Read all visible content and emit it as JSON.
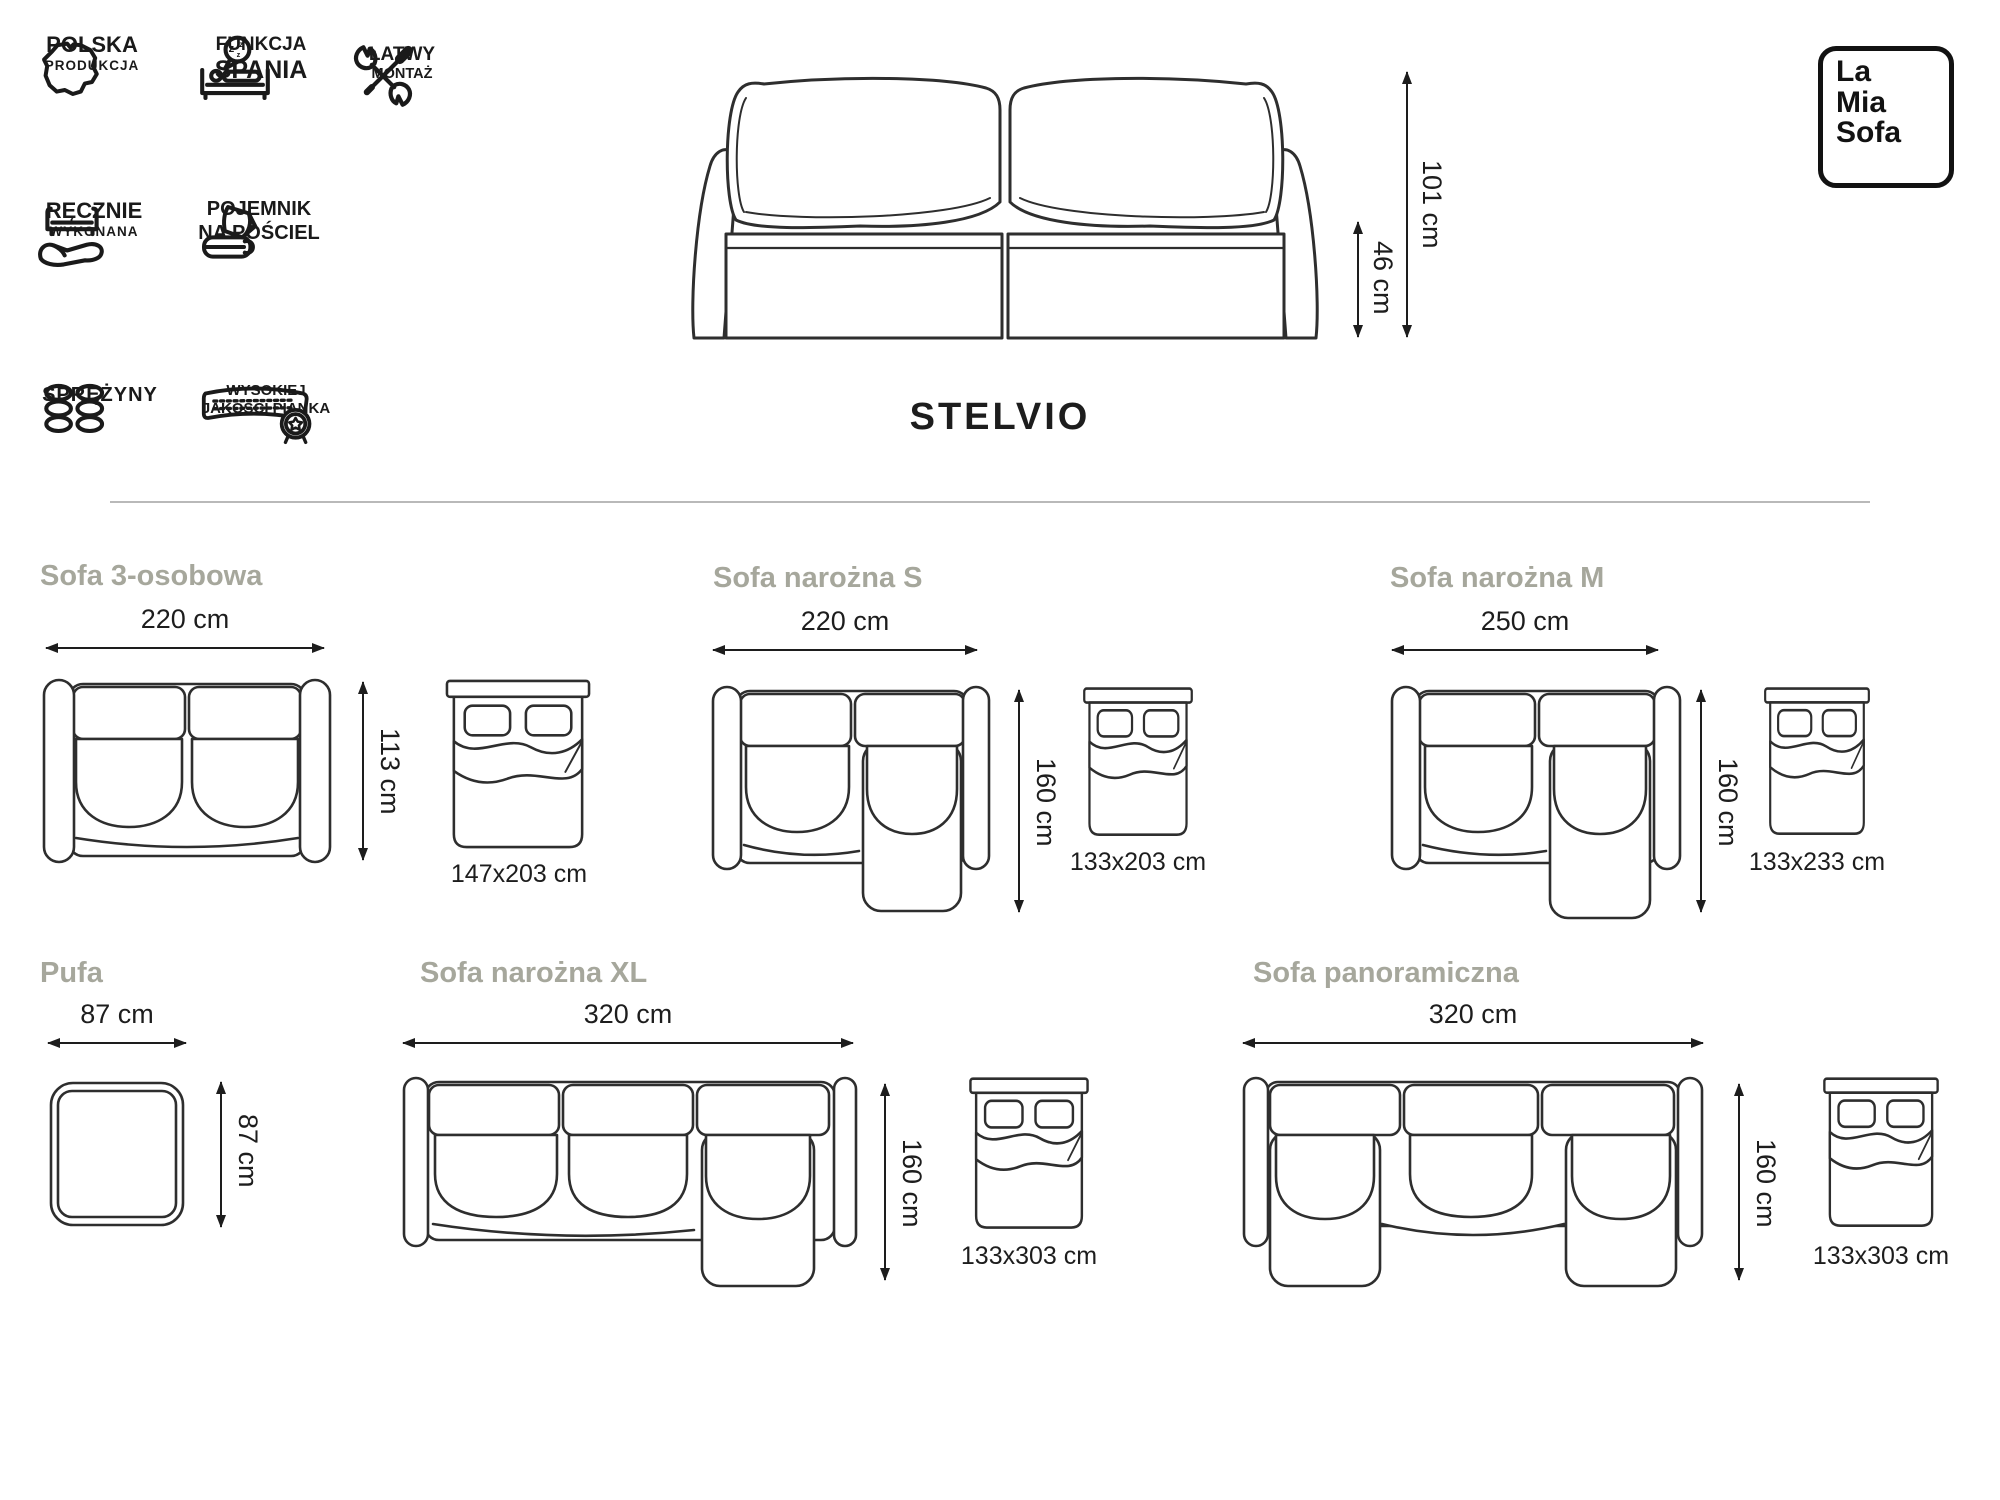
{
  "brand": {
    "line1": "La",
    "line2": "Mia",
    "line3": "Sofa"
  },
  "product": {
    "title": "STELVIO",
    "height_label": "101 cm",
    "seat_height_label": "46 cm"
  },
  "features": [
    {
      "name": "polska-produkcja",
      "line1": "POLSKA",
      "line2": "PRODUKCJA"
    },
    {
      "name": "funkcja-spania",
      "line1": "FUNKCJA",
      "line2": "SPANIA"
    },
    {
      "name": "latwy-montaz",
      "line1": "ŁATWY",
      "line2": "MONTAŻ"
    },
    {
      "name": "recznie-wykonana",
      "line1": "RĘCZNIE",
      "line2": "WYKONANA"
    },
    {
      "name": "pojemnik-na-posciel",
      "line1": "POJEMNIK",
      "line2": "NA POŚCIEL"
    },
    {
      "name": "sprezyny",
      "line1": "SPRĘŻYNY",
      "line2": ""
    },
    {
      "name": "wysokiej-jakosci-pianka",
      "line1": "WYSOKIEJ",
      "line2": "JAKOŚCI PIANKA"
    }
  ],
  "variants": [
    {
      "name": "sofa-3-osobowa",
      "title": "Sofa 3-osobowa",
      "width": "220 cm",
      "depth": "113 cm",
      "bed": "147x203 cm"
    },
    {
      "name": "sofa-narozna-s",
      "title": "Sofa narożna S",
      "width": "220 cm",
      "depth": "160 cm",
      "bed": "133x203 cm"
    },
    {
      "name": "sofa-narozna-m",
      "title": "Sofa narożna M",
      "width": "250 cm",
      "depth": "160 cm",
      "bed": "133x233 cm"
    },
    {
      "name": "pufa",
      "title": "Pufa",
      "width": "87 cm",
      "depth": "87 cm",
      "bed": ""
    },
    {
      "name": "sofa-narozna-xl",
      "title": "Sofa narożna XL",
      "width": "320 cm",
      "depth": "160 cm",
      "bed": "133x303 cm"
    },
    {
      "name": "sofa-panoramiczna",
      "title": "Sofa panoramiczna",
      "width": "320 cm",
      "depth": "160 cm",
      "bed": "133x303 cm"
    }
  ],
  "colors": {
    "ink": "#1d1d1d",
    "muted_title": "#a6a79c",
    "line": "#2e2e2e",
    "divider": "#b9b9b9"
  }
}
